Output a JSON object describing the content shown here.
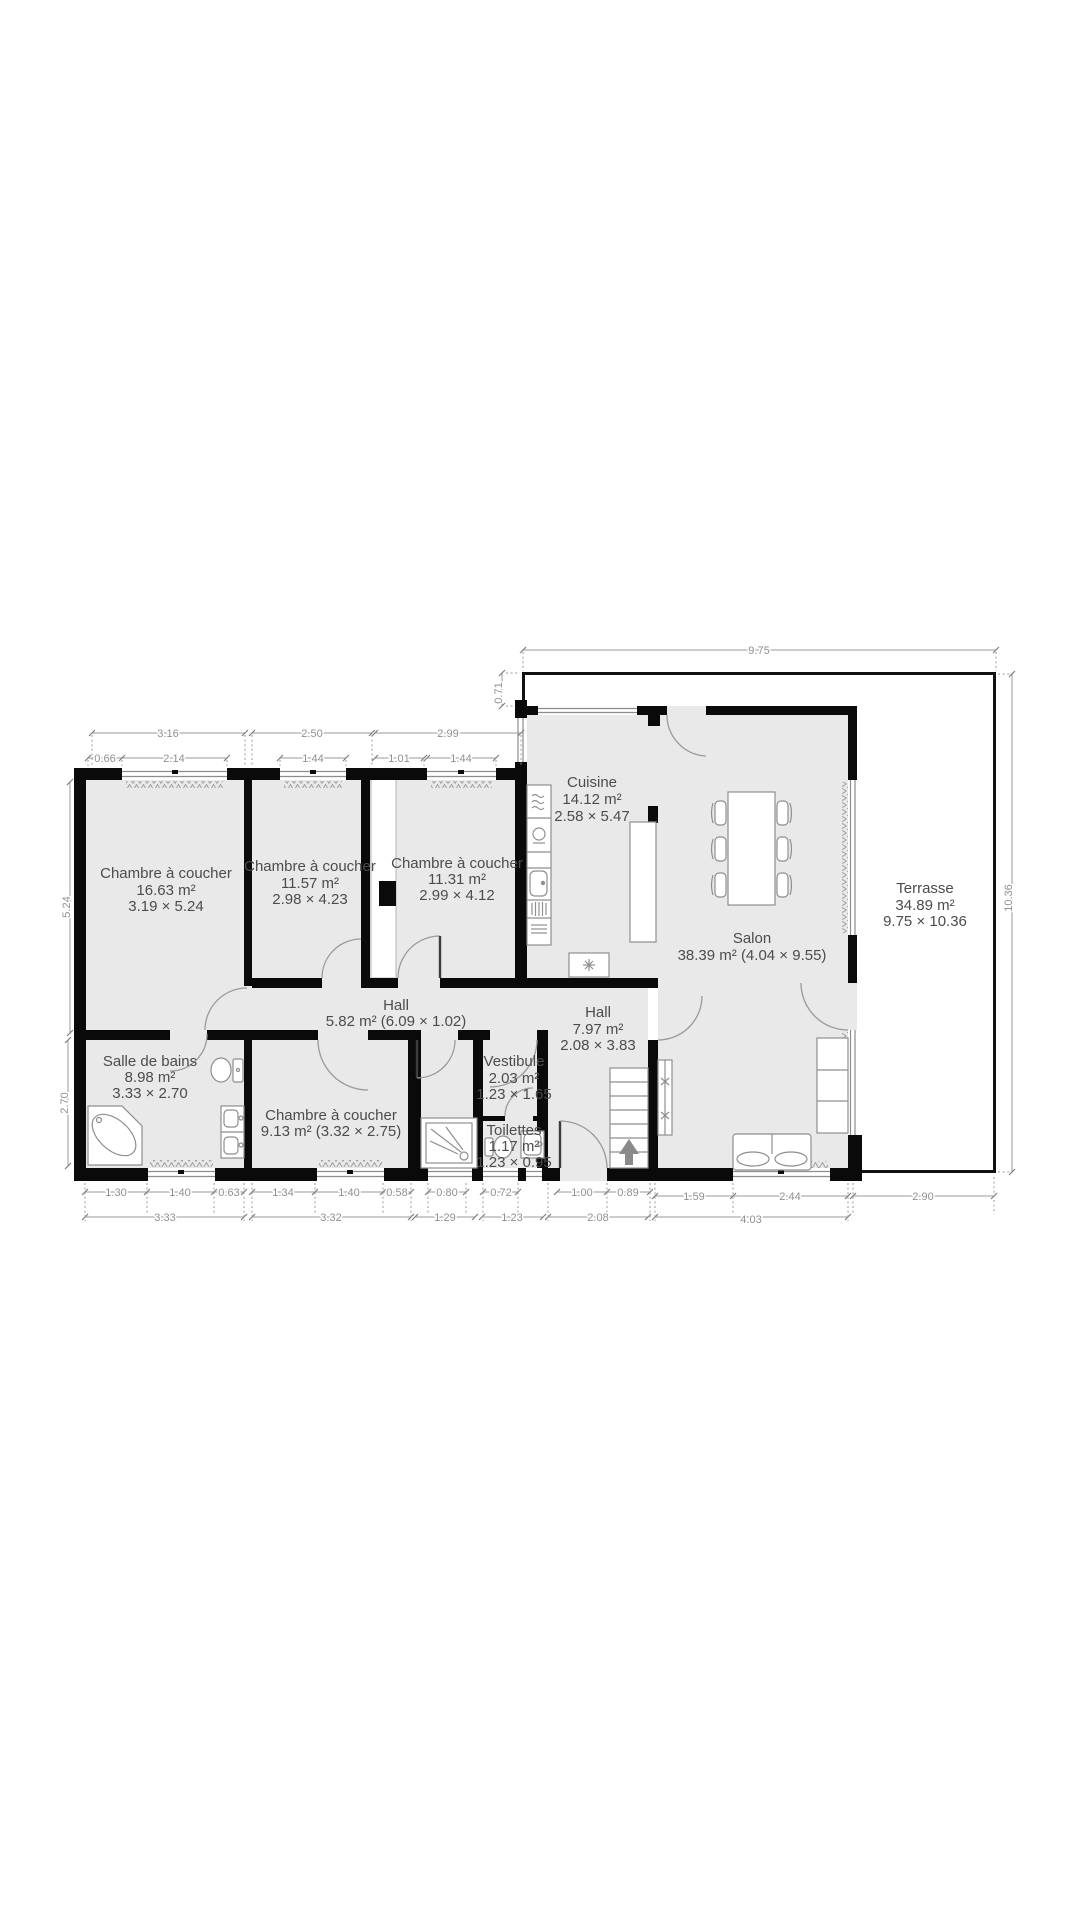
{
  "plan": {
    "rooms": {
      "bedroom1": {
        "name": "Chambre à coucher",
        "area": "16.63 m²",
        "size": "3.19 × 5.24"
      },
      "bedroom2": {
        "name": "Chambre à coucher",
        "area": "11.57 m²",
        "size": "2.98 × 4.23"
      },
      "bedroom3": {
        "name": "Chambre à coucher",
        "area": "11.31 m²",
        "size": "2.99 × 4.12"
      },
      "bedroom4": {
        "name": "Chambre à coucher",
        "area_size": "9.13 m² (3.32 × 2.75)"
      },
      "cuisine": {
        "name": "Cuisine",
        "area": "14.12 m²",
        "size": "2.58 × 5.47"
      },
      "salon": {
        "name": "Salon",
        "area_size": "38.39 m² (4.04 × 9.55)"
      },
      "terrasse": {
        "name": "Terrasse",
        "area": "34.89 m²",
        "size": "9.75 × 10.36"
      },
      "hall": {
        "name": "Hall",
        "area_size": "5.82 m² (6.09 × 1.02)"
      },
      "hall_entry": {
        "name": "Hall",
        "area": "7.97 m²",
        "size": "2.08 × 3.83"
      },
      "bathroom": {
        "name": "Salle de bains",
        "area": "8.98 m²",
        "size": "3.33 × 2.70"
      },
      "vestibule": {
        "name": "Vestibule",
        "area": "2.03 m²",
        "size": "1.23 × 1.65"
      },
      "toilettes": {
        "name": "Toilettes",
        "area": "1.17 m²",
        "size": "1.23 × 0.95"
      }
    },
    "dimensions": {
      "top_width": "9.75",
      "top_offset": "0.71",
      "b1_total": "3.16",
      "b1_off": "0.66",
      "b1_win": "2.14",
      "b2_total": "2.50",
      "b2_win": "1.44",
      "b3_total": "2.99",
      "b3_off": "1.01",
      "b3_win": "1.44",
      "left_upper": "5.24",
      "left_lower": "2.70",
      "right_height": "10.36",
      "bath1": "1.30",
      "bath2": "1.40",
      "bath3": "0.63",
      "bath_total": "3.33",
      "bed4a": "1.34",
      "bed4b": "1.40",
      "bed4c": "0.58",
      "bed4_total": "3.32",
      "shower_win": "0.80",
      "shower_total": "1.29",
      "wc_win": "0.72",
      "wc_total": "1.23",
      "entry_win": "1.00",
      "entry_b": "0.89",
      "entry_total": "2.08",
      "salon_a": "1.59",
      "salon_b": "2.44",
      "salon_total": "4.03",
      "terrace_bottom": "2.90"
    },
    "colors": {
      "wall": "#0a0a0a",
      "floor": "#e9e9e9",
      "label": "#4c4c4c",
      "dim": "#8f8f8f",
      "fixture": "#8f8f8f",
      "terrace": "#111111",
      "winline": "#8c8c8c"
    }
  }
}
